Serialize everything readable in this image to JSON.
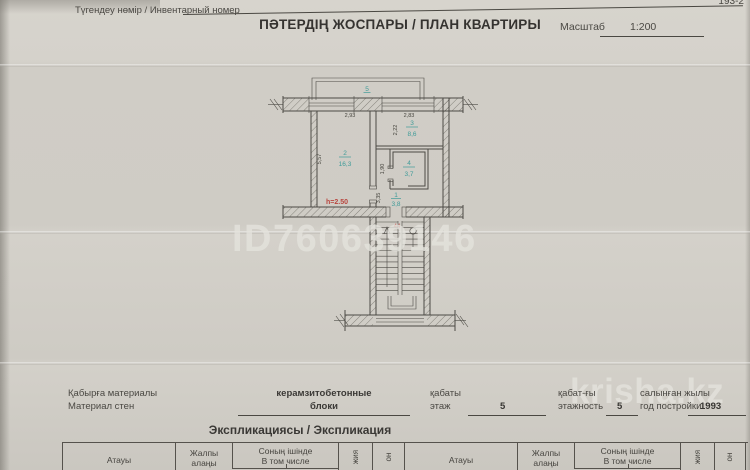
{
  "header": {
    "inventory_label": "Түгендеу нөмір / Инвентарный номер",
    "form_ref": "193-2",
    "title": "ПӘТЕРДІҢ ЖОСПАРЫ / ПЛАН КВАРТИРЫ",
    "scale_label": "Масштаб",
    "scale_value": "1:200"
  },
  "plan": {
    "balcony_label": "5",
    "rooms": {
      "living": {
        "number": "2",
        "area": "16,3"
      },
      "kitchen": {
        "number": "3",
        "area": "8,6"
      },
      "bathroom": {
        "number": "4",
        "area": "3,7"
      },
      "hall": {
        "number": "1",
        "area": "3,8"
      }
    },
    "dims": {
      "living_width": "2,93",
      "kitchen_width": "2,83",
      "living_depth": "5,57",
      "kitchen_depth": "2,22",
      "bathroom_depth": "1,90",
      "hall_depth": "3,35"
    },
    "ceiling_height": "h=2.50",
    "door_number": "44",
    "colors": {
      "room_label": "#3f9b99",
      "annotation_red": "#b8453e",
      "ink": "#4c4a45"
    }
  },
  "watermarks": {
    "listing_id": "ID760639146",
    "site": "krisha.kz"
  },
  "details": {
    "wall_material_label_kz": "Қабырға материалы",
    "wall_material_label_ru": "Материал стен",
    "wall_material_value_1": "керамзитобетонные",
    "wall_material_value_2": "блоки",
    "floor_label_kz": "қабаты",
    "floor_label_ru": "этаж",
    "floor_value": "5",
    "floors_label_kz": "қабат-ғы",
    "floors_label_ru": "этажность",
    "floors_value": "5",
    "year_label_kz": "салынған жылы",
    "year_label_ru": "год постройки",
    "year_value": "1993"
  },
  "explication": {
    "title": "Экспликациясы / Экспликация",
    "columns": {
      "name": "Атауы",
      "total_line1": "Жалпы",
      "total_line2": "алаңы",
      "included_line1": "Соның ішінде",
      "included_line2": "В том числе",
      "rot_col1": "жия",
      "rot_col2": "он"
    }
  }
}
